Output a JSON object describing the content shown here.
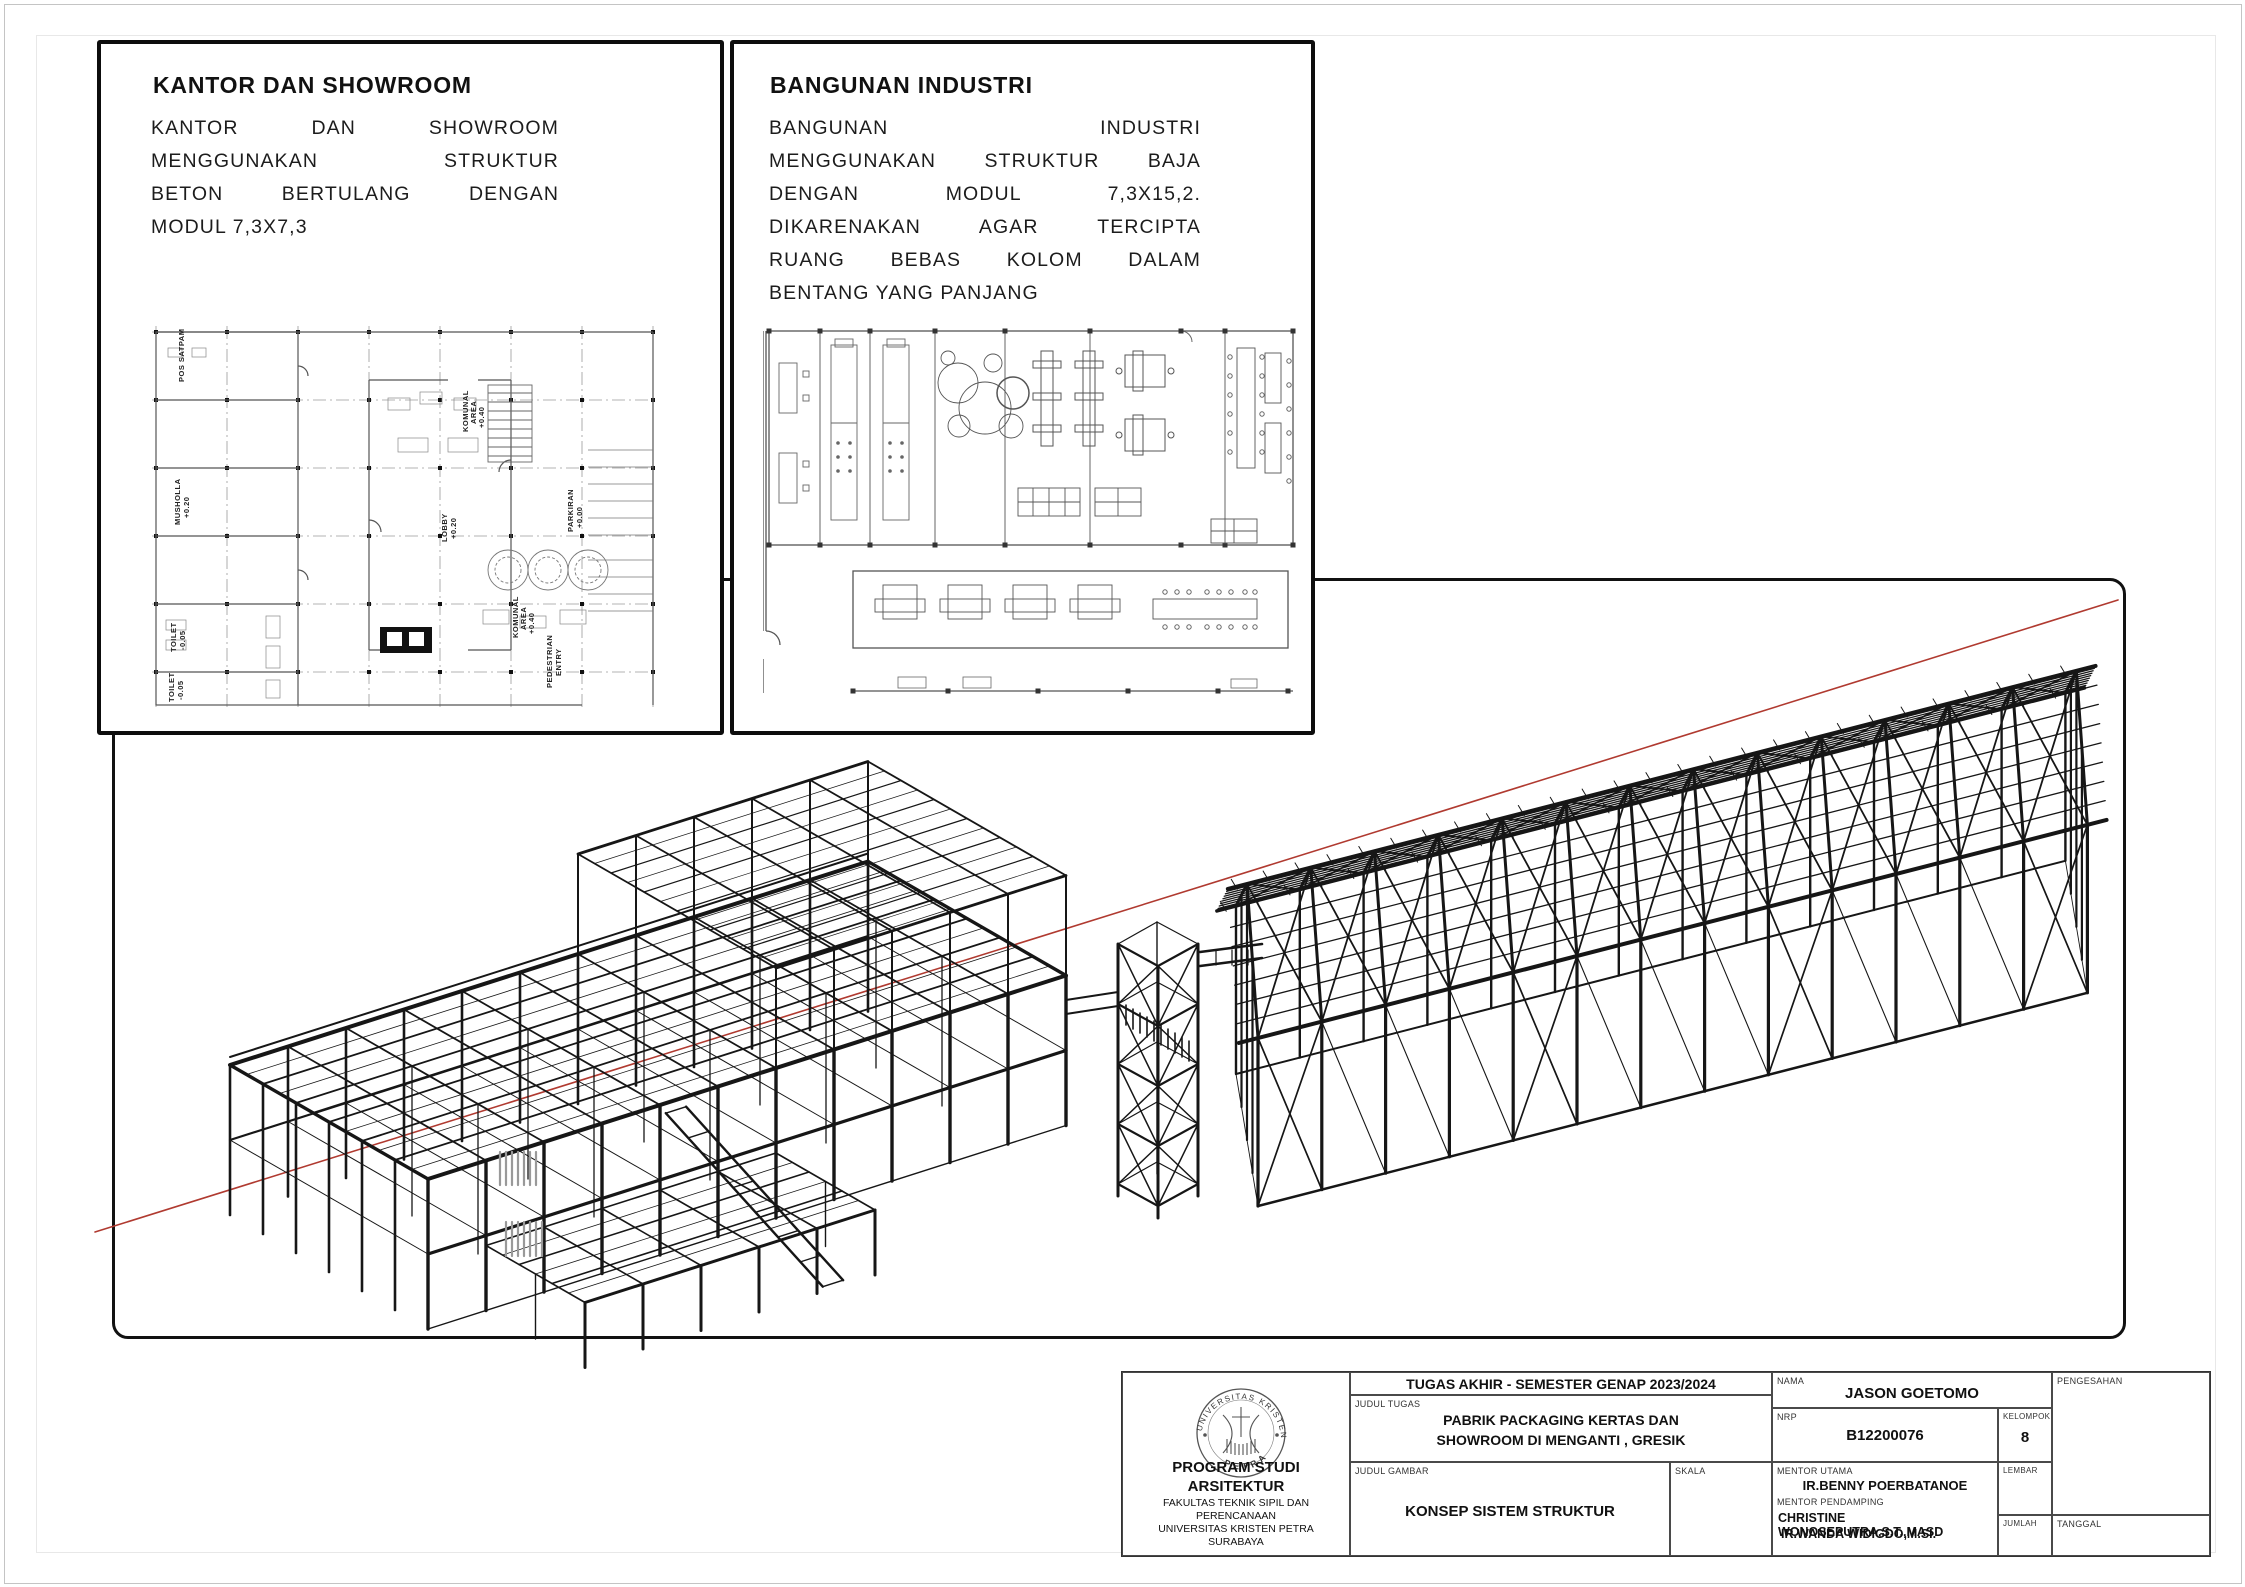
{
  "panels": {
    "kantor": {
      "title": "KANTOR DAN SHOWROOM",
      "body_lines": [
        "KANTOR DAN SHOWROOM",
        "MENGGUNAKAN STRUKTUR",
        "BETON BERTULANG DENGAN",
        "MODUL 7,3X7,3"
      ]
    },
    "industri": {
      "title": "BANGUNAN INDUSTRI",
      "body_lines": [
        "BANGUNAN INDUSTRI",
        "MENGGUNAKAN STRUKTUR BAJA",
        "DENGAN MODUL 7,3X15,2.",
        "DIKARENAKAN AGAR TERCIPTA",
        "RUANG BEBAS KOLOM DALAM",
        "BENTANG YANG PANJANG"
      ]
    }
  },
  "plan1": {
    "labels": {
      "pos_satpam": "POS SATPAM",
      "musholla": "MUSHOLLA",
      "musholla_lv": "+0.20",
      "toilet_a": "TOILET",
      "toilet_a_lv": "-0.05",
      "toilet_b": "TOILET",
      "toilet_b_lv": "-0.05",
      "lobby": "LOBBY",
      "lobby_lv": "+0.20",
      "komunal_a": "KOMUNAL",
      "komunal_a2": "AREA",
      "komunal_a_lv": "+0.40",
      "komunal_b": "KOMUNAL",
      "komunal_b2": "AREA",
      "komunal_b_lv": "+0.40",
      "parkiran": "PARKIRAN",
      "parkiran_lv": "+0.00",
      "pedestrian1": "PEDESTRIAN",
      "pedestrian2": "ENTRY"
    }
  },
  "title_block": {
    "header": "TUGAS AKHIR - SEMESTER GENAP 2023/2024",
    "labels": {
      "judul_tugas": "JUDUL TUGAS",
      "judul_gambar": "JUDUL GAMBAR",
      "skala": "SKALA",
      "nama": "NAMA",
      "nrp": "NRP",
      "kelompok": "KELOMPOK",
      "mentor_utama": "MENTOR UTAMA",
      "mentor_pendamping": "MENTOR PENDAMPING",
      "lembar": "LEMBAR",
      "jumlah": "JUMLAH",
      "pengesahan": "PENGESAHAN",
      "tanggal": "TANGGAL"
    },
    "values": {
      "judul_tugas_1": "PABRIK PACKAGING KERTAS DAN",
      "judul_tugas_2": "SHOWROOM DI MENGANTI , GRESIK",
      "judul_gambar": "KONSEP SISTEM STRUKTUR",
      "nama": "JASON GOETOMO",
      "nrp": "B12200076",
      "kelompok": "8",
      "mentor_utama": "IR.BENNY POERBATANOE",
      "mentor_pendamping_1": "CHRISTINE WONOSEPUTRA,S.T.,MASD",
      "mentor_pendamping_2": "IR.WANDA WIDIGDO,M.SI."
    },
    "institution": {
      "line1": "PROGRAM STUDI ARSITEKTUR",
      "line2": "FAKULTAS TEKNIK SIPIL DAN PERENCANAAN",
      "line3": "UNIVERSITAS KRISTEN PETRA",
      "line4": "SURABAYA"
    },
    "logo": {
      "top_text": "UNIVERSITAS KRISTEN",
      "bottom_text": "PETRA"
    }
  },
  "colors": {
    "structure": "#161616",
    "red_guide": "#b03a30",
    "plan_line": "#555555",
    "grid_line": "#9a9a9a"
  }
}
